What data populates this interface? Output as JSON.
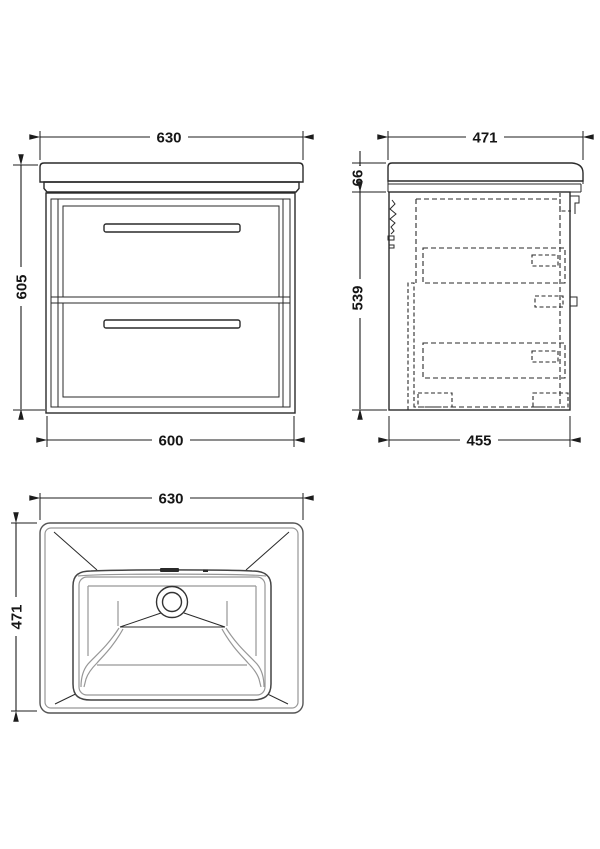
{
  "colors": {
    "background": "#ffffff",
    "line": "#2a2a2a",
    "light_line": "#979797",
    "dimension_line": "#1c1c1c"
  },
  "views": {
    "front": {
      "dim_top_width": "630",
      "dim_height": "605",
      "dim_bottom_width": "600"
    },
    "side": {
      "dim_top_depth": "471",
      "dim_basin_height": "66",
      "dim_cabinet_height": "539",
      "dim_bottom_depth": "455"
    },
    "plan": {
      "dim_width": "630",
      "dim_depth": "471"
    }
  }
}
